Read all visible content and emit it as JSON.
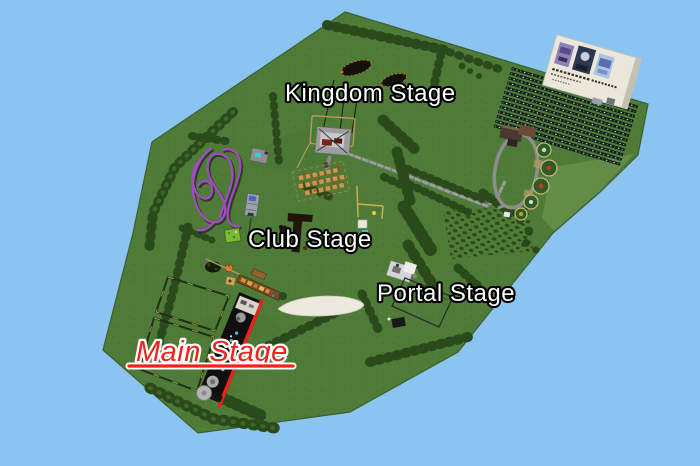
{
  "map": {
    "colors": {
      "water": "#8BC4F1",
      "grass": "#4F7B38",
      "tree": "#2B4A1C",
      "path": "#9C9C9C",
      "coaster_track": "#A14CBE",
      "main_stage_red": "#EE231B"
    },
    "labels": {
      "kingdom": {
        "text": "Kingdom Stage",
        "fill": "#FFFFFF",
        "outline": "#000000"
      },
      "club": {
        "text": "Club Stage",
        "fill": "#FFFFFF",
        "outline": "#000000"
      },
      "portal": {
        "text": "Portal Stage",
        "fill": "#FFFFFF",
        "outline": "#000000"
      },
      "main": {
        "text": "Main Stage",
        "fill": "#EE231B",
        "outline": "#FFFFFF",
        "underline": true
      }
    },
    "landmarks": [
      {
        "name": "roller-coaster"
      },
      {
        "name": "kingdom-stage-structure"
      },
      {
        "name": "market-stalls"
      },
      {
        "name": "club-stage-structure"
      },
      {
        "name": "campground-gardens"
      },
      {
        "name": "parking-lot"
      },
      {
        "name": "entrance-billboard"
      },
      {
        "name": "portal-stage-structure"
      },
      {
        "name": "main-stage-structure"
      },
      {
        "name": "boat-canopy"
      },
      {
        "name": "crop-fields"
      },
      {
        "name": "bush-orchard"
      }
    ]
  }
}
